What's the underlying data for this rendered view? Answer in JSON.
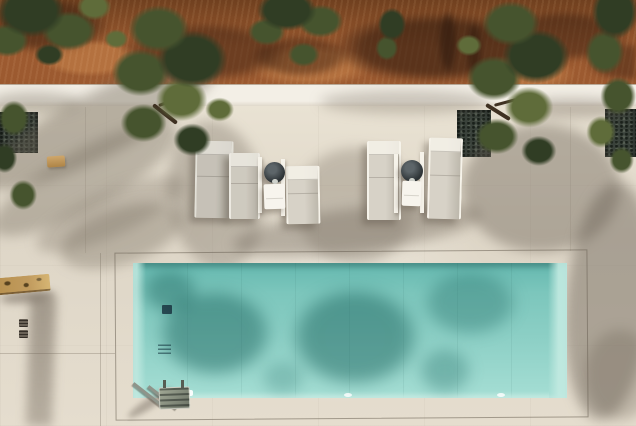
{
  "meta": {
    "type": "aerial-photograph",
    "description": "Top-down drone view of a rectangular turquoise swimming pool set into a cream stone terrace. A strip of terracotta earth with olive trees runs along the top behind a low white wall. Five sun loungers in two groups with two dark round side tables and white towel tables sit between the wall and the pool. Olive tree canopies and their shadows fall across the terrace and the water. A stainless steel ladder is at the pool's bottom-left corner, a rough stone wall enters at the lower left, and dark gravel planter beds line the upper terrace."
  },
  "palette": {
    "earth": "#9c5a30",
    "earth_light": "#b4713f",
    "earth_dark": "#70401f",
    "wall": "#f3efe6",
    "wall_edge": "#d9d0c1",
    "patio": "#ded6c7",
    "pool_deep": "#65b8af",
    "pool_mid": "#8ccfc5",
    "pool_light": "#a5ded4",
    "pool_wall": "#c2eae1",
    "foliage_dark": "#303d24",
    "foliage": "#46542e",
    "foliage_light": "#5f6c3a",
    "trunk": "#3f3122",
    "gravel": "#3a423b",
    "frame_white": "#f6f3ea",
    "cushion": "#d7d2c7",
    "cushion_dark": "#bdb8ac",
    "table_dark": "#2d3336",
    "table_light": "#5d6569",
    "towel": "#f7f4ed",
    "metal": "#8f948a",
    "metal_dark": "#565c52",
    "stone": "#c19b5e",
    "stone_dark": "#57421f"
  },
  "scene": {
    "ground": {
      "upper_band": "terracotta earth of olive grove",
      "wall_strip": "low white boundary wall",
      "terrace": "cream stone pavers with expansion joints"
    },
    "pool": {
      "shape": "rectangle",
      "water_color_name": "turquoise",
      "features": [
        "tree shadow reflections",
        "floor drain grate",
        "wall jets",
        "white skimmer lid",
        "two floor lights",
        "stainless ladder at bottom-left corner"
      ]
    },
    "furniture": {
      "sun_loungers": 5,
      "round_side_tables": 2,
      "white_towel_tables": 2,
      "arrangement": "two groups between the low wall and the pool"
    },
    "planter_beds": 3,
    "trees": {
      "type": "olive",
      "visible_canopies": 7
    },
    "misc": [
      "diagonal stone wall at bottom-left",
      "two small drain grates on terrace",
      "small tan object on terrace"
    ]
  }
}
